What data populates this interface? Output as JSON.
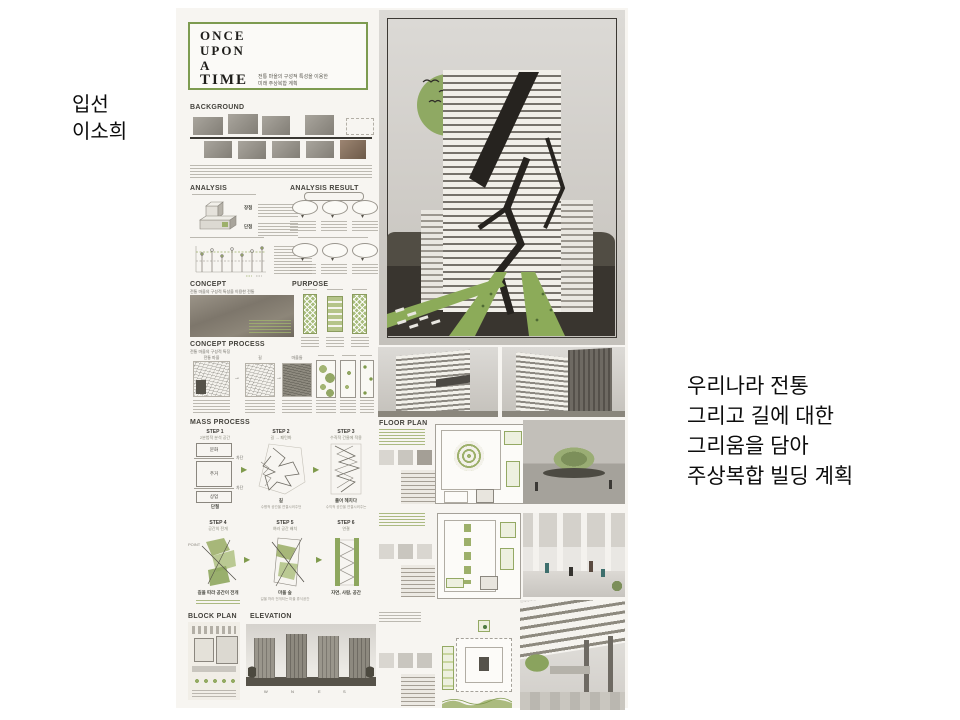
{
  "slide": {
    "award": "입선",
    "author": "이소희",
    "caption_lines": [
      "우리나라 전통",
      "그리고 길에 대한",
      "그리움을 담아",
      "주상복합 빌딩 계획"
    ]
  },
  "poster": {
    "accent_green": "#7d9b50",
    "title_lines": [
      "ONCE",
      "UPON",
      "A",
      "TIME"
    ],
    "subtitle_lines": [
      "전통 마을의 구성적 특성을 이용한",
      "미래 주상복합 계획"
    ],
    "headings": {
      "background": "BACKGROUND",
      "analysis": "ANALYSIS",
      "analysis_result": "ANALYSIS RESULT",
      "concept": "CONCEPT",
      "concept_sub": "전통 마을의 구성적 특성을 이용한 전통",
      "purpose": "PURPOSE",
      "concept_process": "CONCEPT PROCESS",
      "concept_process_sub": "전통 마을의 구성적 특징",
      "mass_process": "MASS PROCESS",
      "block_plan": "BLOCK PLAN",
      "elevation": "ELEVATION",
      "floor_plan": "FLOOR PLAN"
    },
    "analysis": {
      "pros_label": "장점",
      "cons_label": "단점"
    },
    "concept_process_maps": [
      "전통 마을",
      "길",
      "마을들"
    ],
    "mass_steps": [
      {
        "label": "STEP 1",
        "sub": "2분법적 분석 공간",
        "caption": "단절"
      },
      {
        "label": "STEP 2",
        "sub": "길 → 패턴화",
        "caption": "길",
        "note": "수평적 공간을 연결시켜주던"
      },
      {
        "label": "STEP 3",
        "sub": "수직적 건물에 적용",
        "caption": "풀어 헤치다",
        "note": "수직적 공간을 연결시켜주는"
      },
      {
        "label": "STEP 4",
        "sub": "공간의 전개",
        "caption": "길을 따라 공간이 전개"
      },
      {
        "label": "STEP 5",
        "sub": "여러 공간 배치",
        "caption": "마을 숲",
        "note": "길을 따라 전개되는 마을 휴식공간"
      },
      {
        "label": "STEP 6",
        "sub": "연결",
        "caption": "자연, 사람, 공간"
      }
    ],
    "step1_zones": [
      "문화",
      "주거",
      "상업"
    ],
    "step1_barrier": "차단",
    "point_label": "POINT",
    "elevation_letters": [
      "W",
      "N",
      "E",
      "S"
    ]
  }
}
